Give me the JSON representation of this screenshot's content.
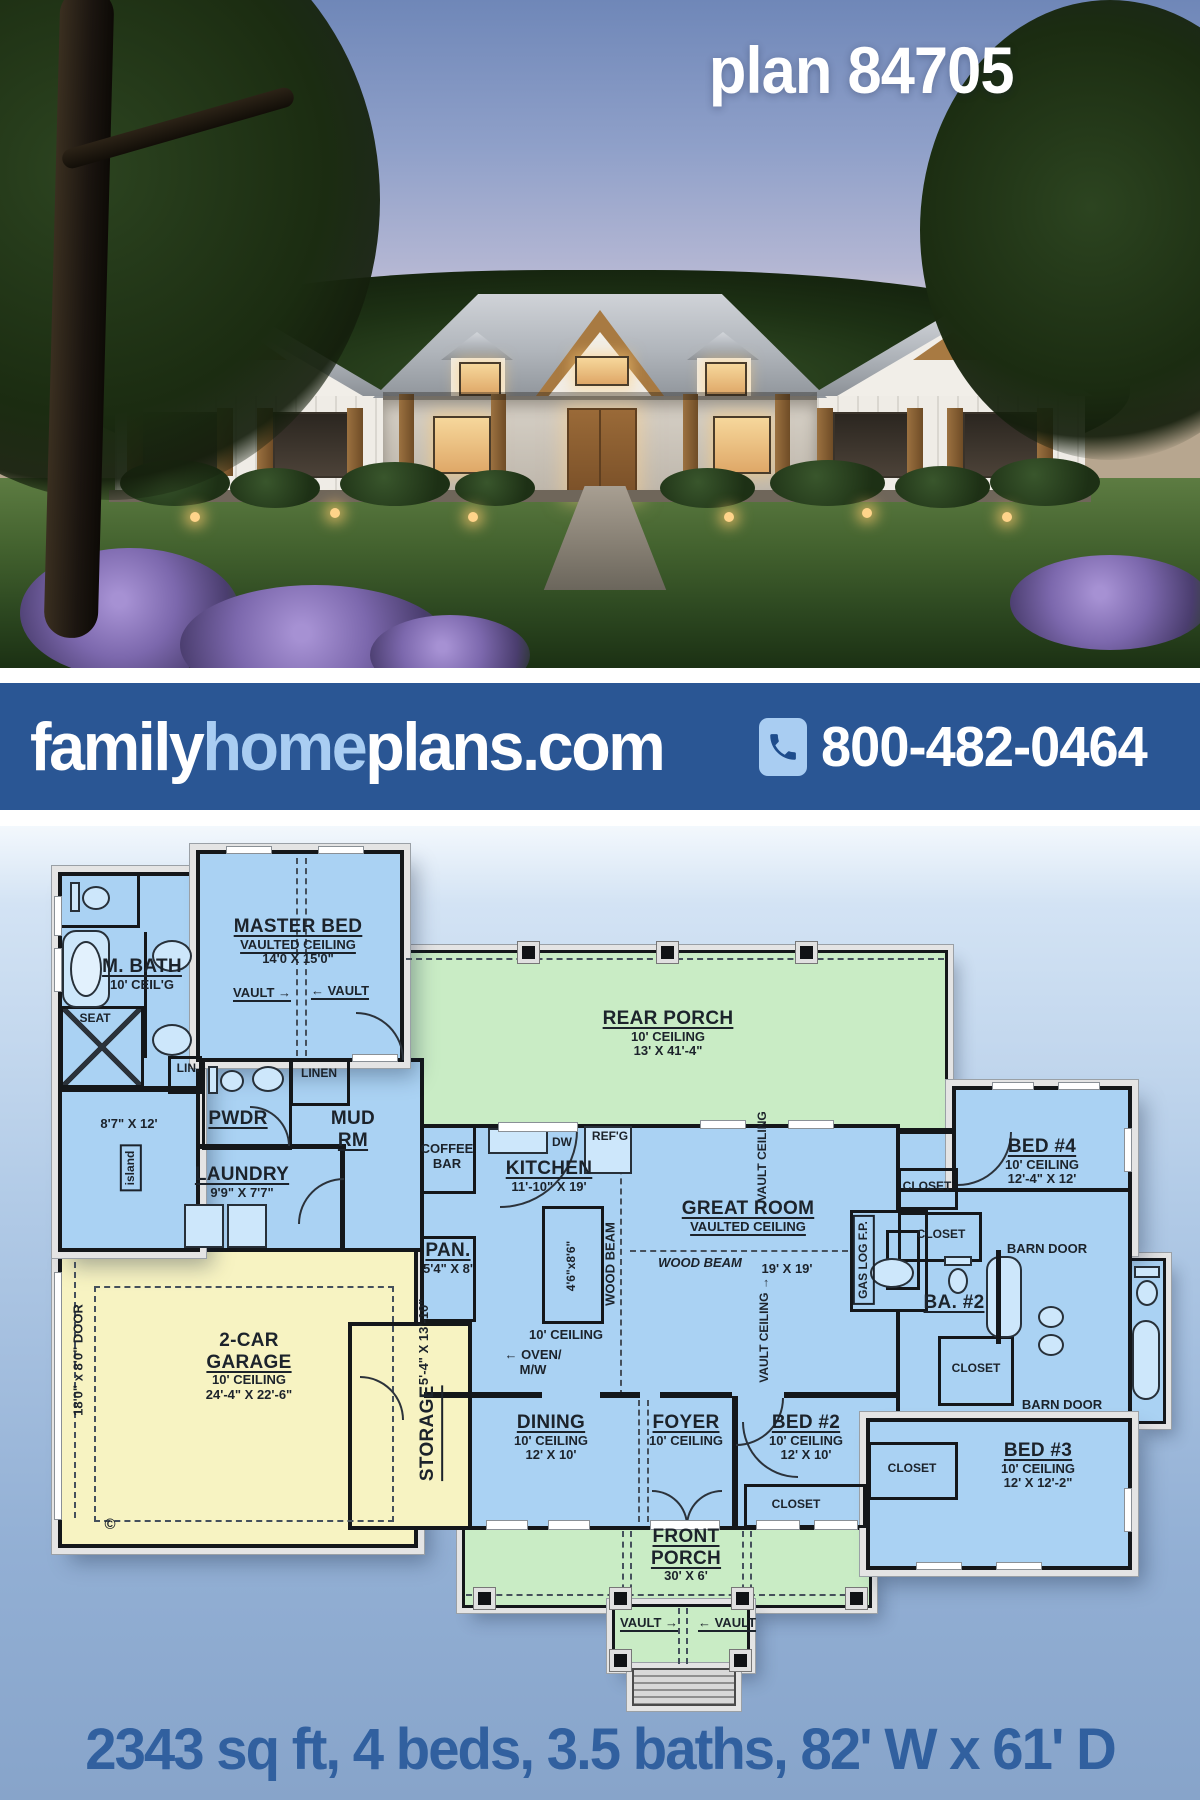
{
  "photo": {
    "plan_label": "plan 84705"
  },
  "banner": {
    "logo_family": "family",
    "logo_home": "home",
    "logo_plans": "plans.com",
    "phone": "800-482-0464",
    "phone_icon": "phone-handset-icon"
  },
  "stats": {
    "line": "2343 sq ft, 4 beds, 3.5 baths, 82' W x 61' D"
  },
  "colors": {
    "banner_bg": "#2a5694",
    "logo_home_accent": "#a9cdf2",
    "stats_text": "#31609f",
    "plan_room_blue": "#aad2f3",
    "porch_green": "#c9ecc5",
    "garage_yellow": "#f7f3c2",
    "wall_black": "#14171a"
  },
  "plan": {
    "labels": {
      "master_bed": {
        "lines": [
          "MASTER BED",
          "VAULTED CEILING",
          "14'0 X 15'0\""
        ]
      },
      "vault_master_left": {
        "lines": [
          "VAULT →"
        ]
      },
      "vault_master_right": {
        "lines": [
          "← VAULT"
        ]
      },
      "m_bath": {
        "lines": [
          "M. BATH",
          "10' CEIL'G"
        ]
      },
      "seat": {
        "lines": [
          "SEAT"
        ]
      },
      "lin": {
        "lines": [
          "LIN."
        ]
      },
      "linen": {
        "lines": [
          "LINEN"
        ]
      },
      "pwdr": {
        "lines": [
          "PWDR"
        ]
      },
      "mud_rm": {
        "lines": [
          "MUD",
          "RM"
        ]
      },
      "laundry": {
        "lines": [
          "LAUNDRY",
          "9'9\" X 7'7\""
        ]
      },
      "closet_dim": {
        "lines": [
          "8'7\" X 12'"
        ]
      },
      "island": {
        "lines": [
          "island"
        ]
      },
      "coffee_bar": {
        "lines": [
          "COFFEE",
          "BAR"
        ]
      },
      "pan": {
        "lines": [
          "PAN.",
          "5'4\" X 8'"
        ]
      },
      "storage": {
        "lines": [
          "STORAGE",
          "5'-4\" X 13'-10\""
        ]
      },
      "garage": {
        "lines": [
          "2-CAR",
          "GARAGE",
          "10' CEILING",
          "24'-4\" X 22'-6\""
        ]
      },
      "garage_door": {
        "lines": [
          "18'0\" x 8'0\" DOOR"
        ]
      },
      "copyright": {
        "lines": [
          "©"
        ]
      },
      "rear_porch": {
        "lines": [
          "REAR PORCH",
          "10' CEILING",
          "13' X 41'-4\""
        ]
      },
      "kitchen": {
        "lines": [
          "KITCHEN",
          "11'-10\" X 19'"
        ]
      },
      "dw": {
        "lines": [
          "DW"
        ]
      },
      "refg": {
        "lines": [
          "REF'G"
        ]
      },
      "island_dim": {
        "lines": [
          "4'6\"x8'6\""
        ]
      },
      "kitchen_ceiling": {
        "lines": [
          "10' CEILING"
        ]
      },
      "oven_mw": {
        "lines": [
          "← OVEN/",
          "M/W"
        ]
      },
      "wood_beam_v": {
        "lines": [
          "WOOD BEAM"
        ]
      },
      "wood_beam_h": {
        "lines": [
          "WOOD BEAM"
        ]
      },
      "great_room": {
        "lines": [
          "GREAT ROOM",
          "VAULTED CEILING"
        ]
      },
      "great_dim": {
        "lines": [
          "19' X 19'"
        ]
      },
      "vault_ceiling_1": {
        "lines": [
          "← VAULT CEILING"
        ]
      },
      "vault_ceiling_2": {
        "lines": [
          "VAULT CEILING →"
        ]
      },
      "gas_log": {
        "lines": [
          "GAS LOG F.P."
        ]
      },
      "closet_a": {
        "lines": [
          "CLOSET"
        ]
      },
      "closet_b": {
        "lines": [
          "CLOSET"
        ]
      },
      "bed4": {
        "lines": [
          "BED #4",
          "10' CEILING",
          "12'-4\" X 12'"
        ]
      },
      "barn_door_1": {
        "lines": [
          "BARN DOOR"
        ]
      },
      "ba2": {
        "lines": [
          "BA. #2"
        ]
      },
      "closet_c": {
        "lines": [
          "CLOSET"
        ]
      },
      "barn_door_2": {
        "lines": [
          "BARN DOOR"
        ]
      },
      "bed3": {
        "lines": [
          "BED #3",
          "10' CEILING",
          "12' X 12'-2\""
        ]
      },
      "closet_d": {
        "lines": [
          "CLOSET"
        ]
      },
      "dining": {
        "lines": [
          "DINING",
          "10' CEILING",
          "12' X 10'"
        ]
      },
      "foyer": {
        "lines": [
          "FOYER",
          "10' CEILING"
        ]
      },
      "bed2": {
        "lines": [
          "BED #2",
          "10' CEILING",
          "12' X 10'"
        ]
      },
      "closet_e": {
        "lines": [
          "CLOSET"
        ]
      },
      "front_porch": {
        "lines": [
          "FRONT",
          "PORCH",
          "30' X 6'"
        ]
      },
      "vault_porch_left": {
        "lines": [
          "VAULT →"
        ]
      },
      "vault_porch_right": {
        "lines": [
          "← VAULT"
        ]
      }
    }
  }
}
